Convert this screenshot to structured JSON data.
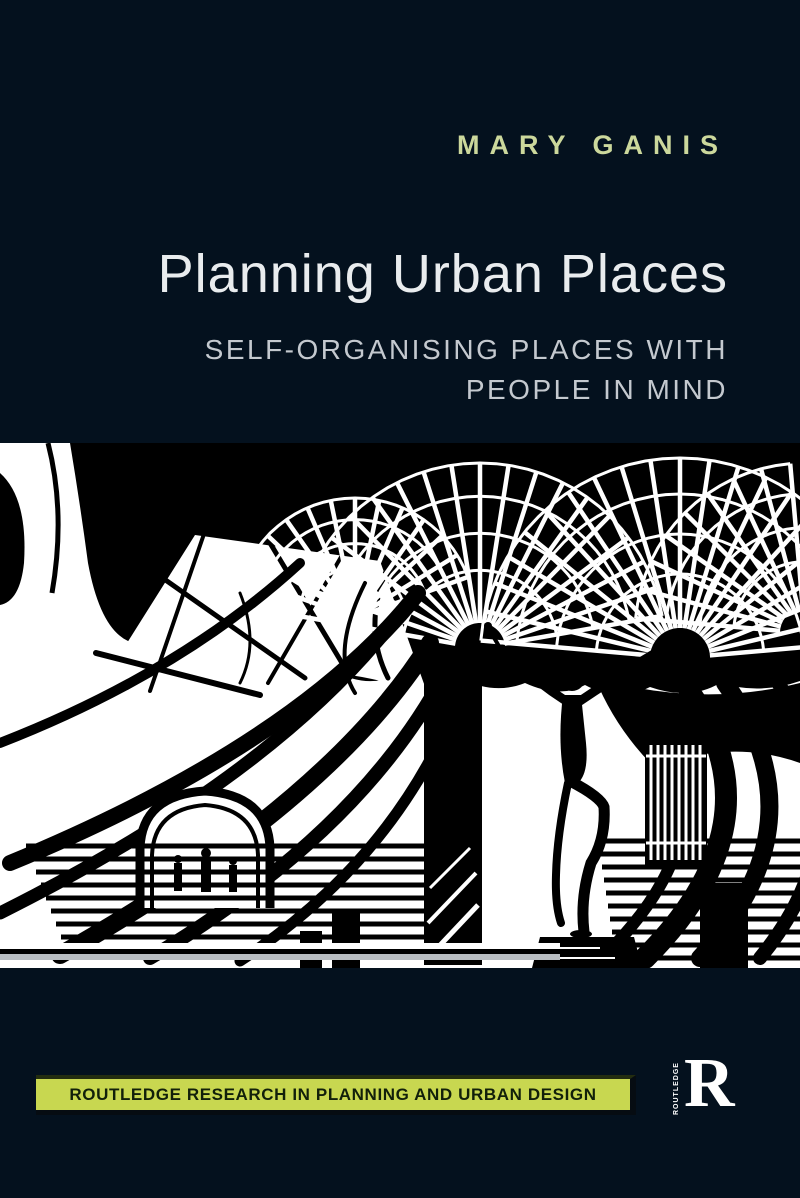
{
  "cover": {
    "author": "MARY GANIS",
    "title": "Planning Urban Places",
    "subtitle_line1": "SELF-ORGANISING PLACES WITH",
    "subtitle_line2": "PEOPLE IN MIND",
    "series_label": "ROUTLEDGE RESEARCH IN PLANNING AND URBAN DESIGN",
    "publisher": {
      "name_vertical": "ROUTLEDGE",
      "monogram": "R"
    },
    "artwork_description": "High-contrast black and white woodcut-style illustration of an urban place: lattice gridshell canopies, sweeping branch-like arches, public steps with small figures, and a dancing statue on a pedestal",
    "colors": {
      "background": "#04111e",
      "author_text": "#ccd89c",
      "title_text": "#e9ecee",
      "subtitle_text": "#c4c9cf",
      "series_bar_bg": "#c8d750",
      "series_bar_text": "#12200a",
      "artwork_black": "#000000",
      "artwork_white": "#ffffff",
      "logo_white": "#ffffff"
    }
  }
}
